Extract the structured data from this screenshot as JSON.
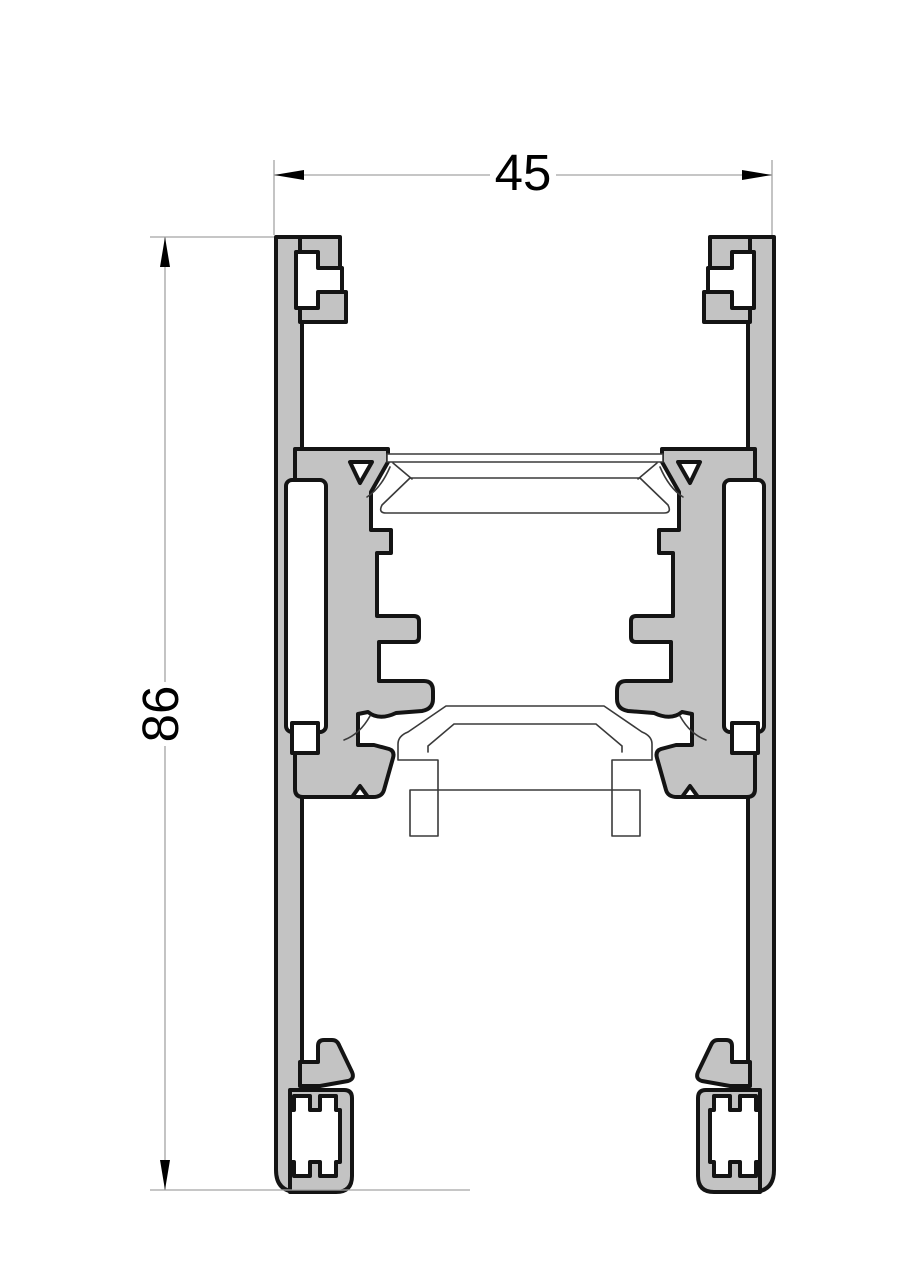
{
  "drawing": {
    "kind": "profile-cross-section",
    "dimensions": {
      "width": {
        "value": "45",
        "orientation": "horizontal",
        "position": "top"
      },
      "height": {
        "value": "86",
        "orientation": "vertical",
        "position": "left"
      }
    },
    "colors": {
      "background": "#ffffff",
      "profile_fill": "#c3c3c3",
      "outline": "#141414",
      "thin_line": "#3a3a3a",
      "dimension_line": "#a3a3a3",
      "dimension_text": "#000000"
    }
  }
}
